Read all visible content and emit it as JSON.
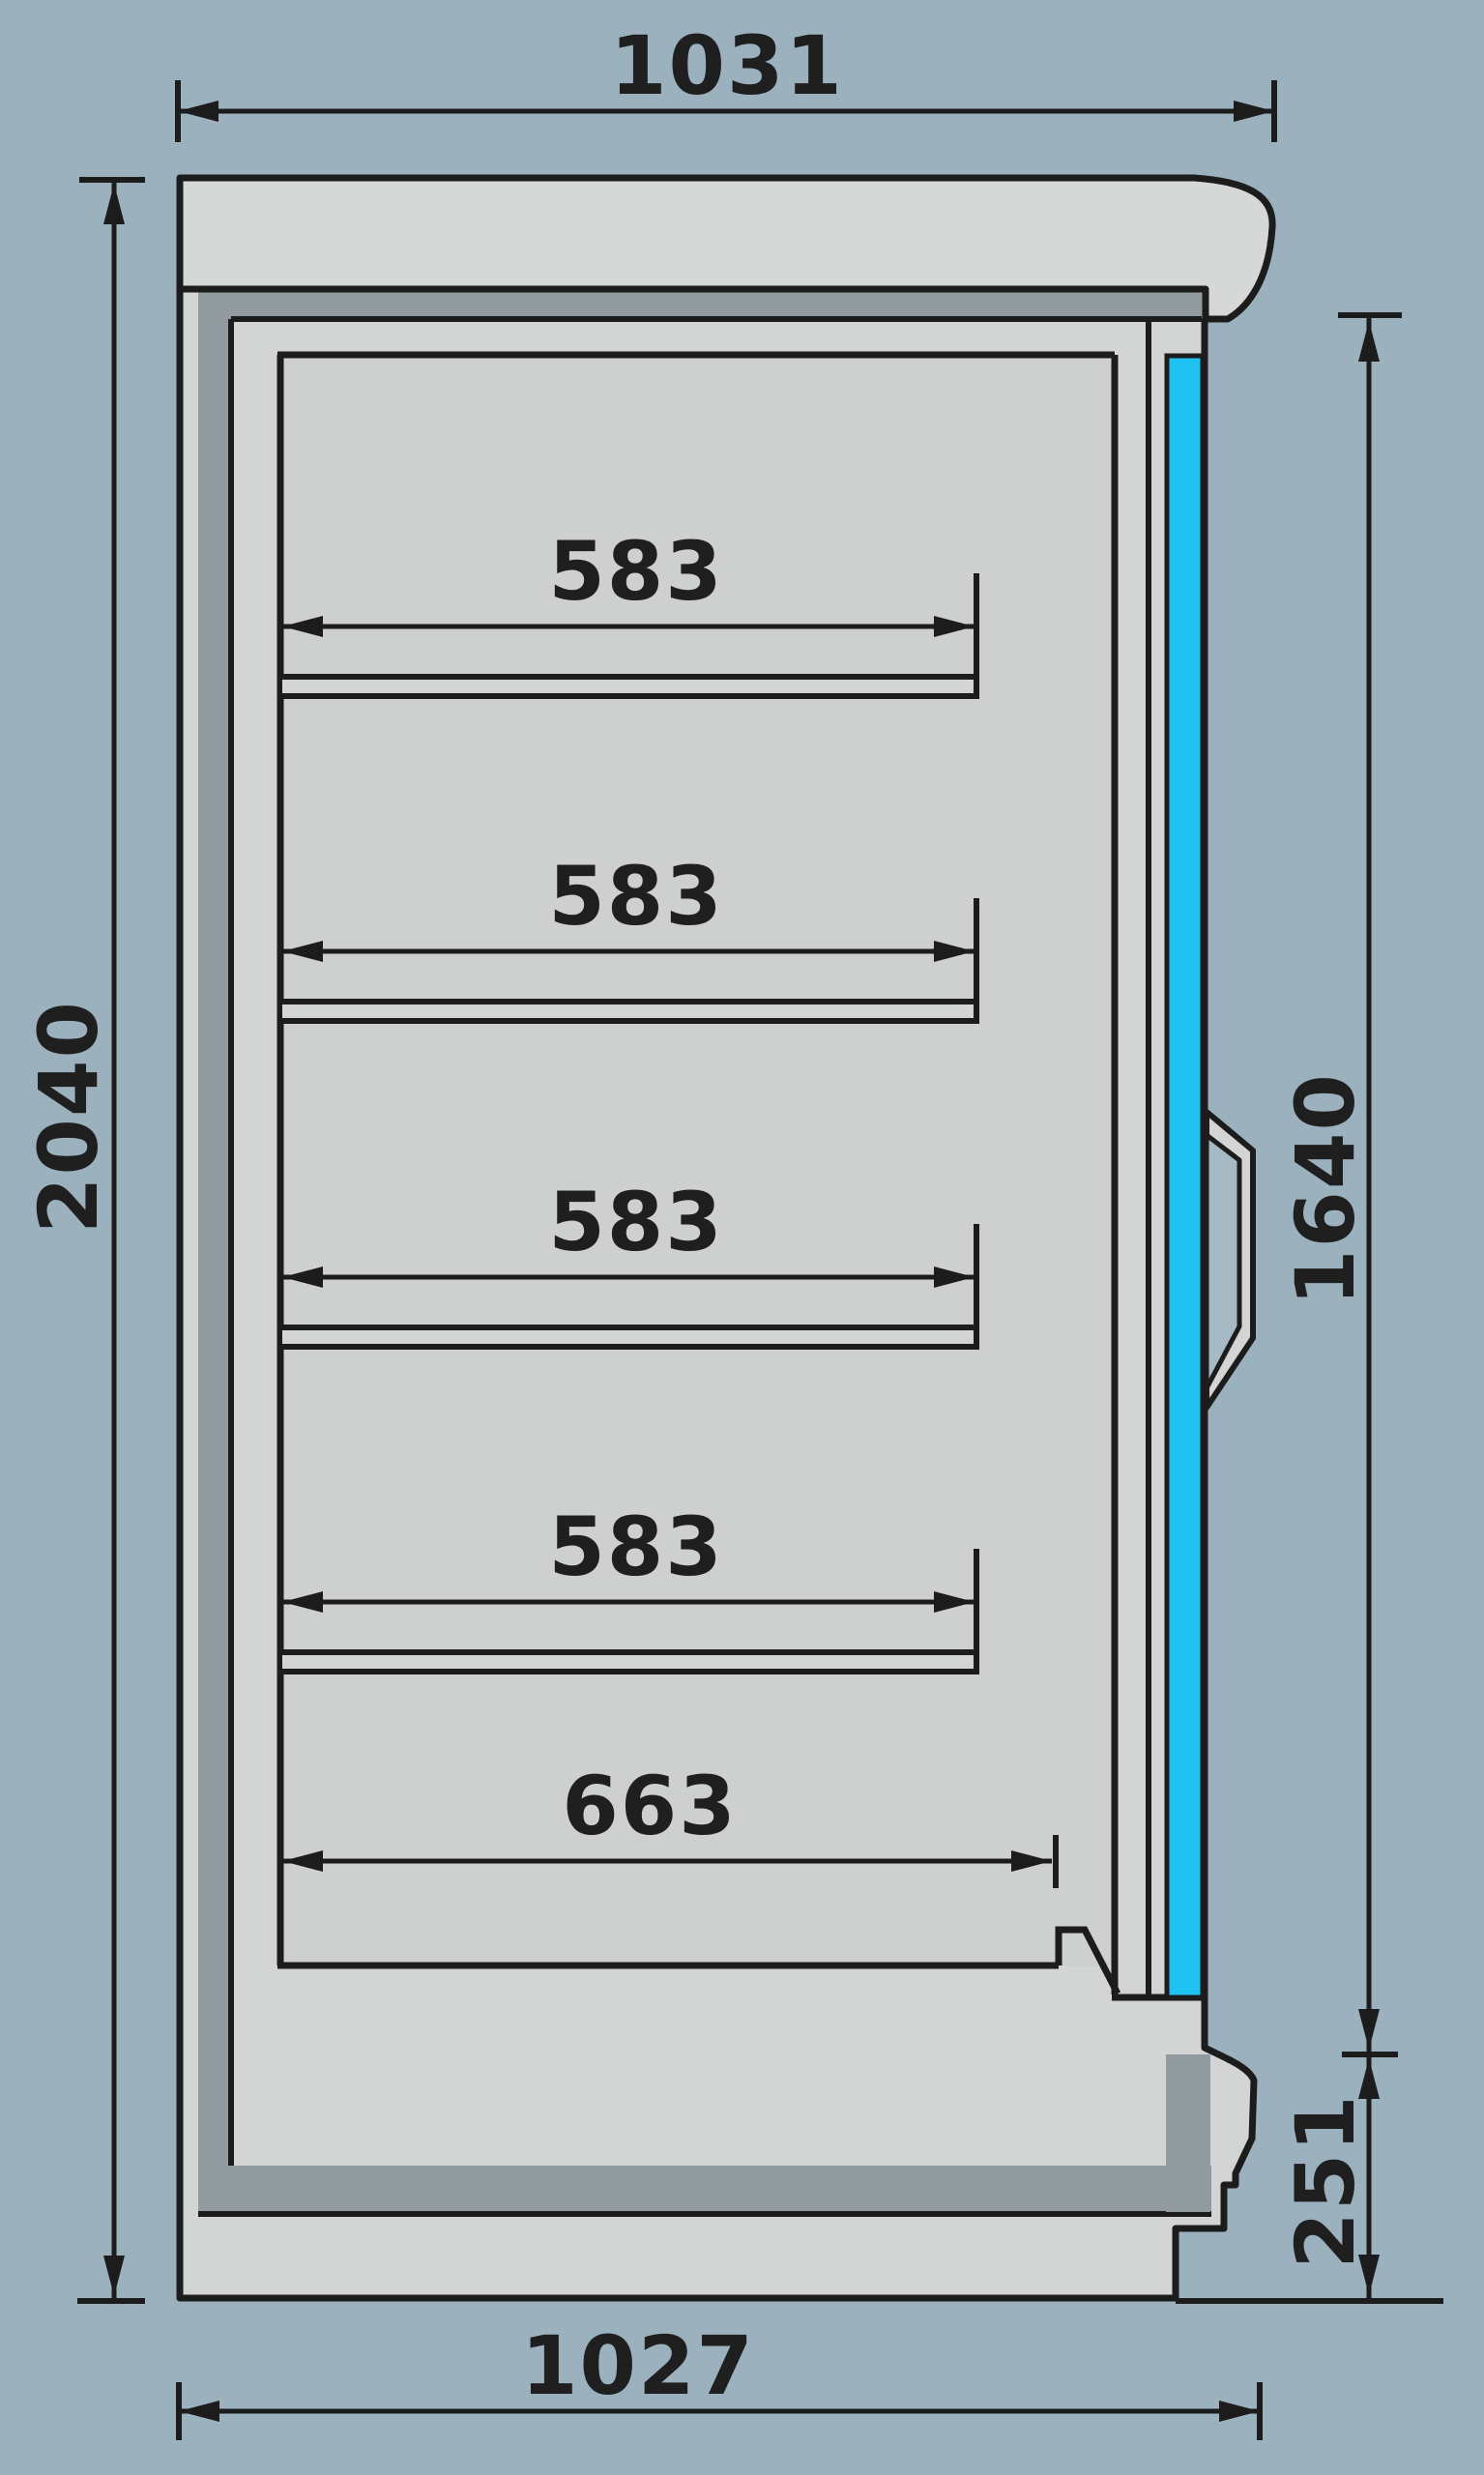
{
  "title": "Refrigerated wall cabinet side-section dimensional drawing",
  "colors": {
    "background": "#9BB1BE",
    "body_fill": "#D3D5D4",
    "canopy_fill": "#D6D8D7",
    "cavity_fill": "#CDD0CF",
    "frame_dark": "#919A9E",
    "glass_cyan": "#1EC1EF",
    "line_black": "#1C1C1C",
    "handle_hollow": "#A6BAC5"
  },
  "dimensions": {
    "top_width": {
      "label": "1031"
    },
    "overall_height": {
      "label": "2040"
    },
    "door_height": {
      "label": "1640"
    },
    "base_height": {
      "label": "251"
    },
    "bottom_width": {
      "label": "1027"
    },
    "shelves": [
      {
        "label": "583"
      },
      {
        "label": "583"
      },
      {
        "label": "583"
      },
      {
        "label": "583"
      },
      {
        "label": "663"
      }
    ]
  }
}
